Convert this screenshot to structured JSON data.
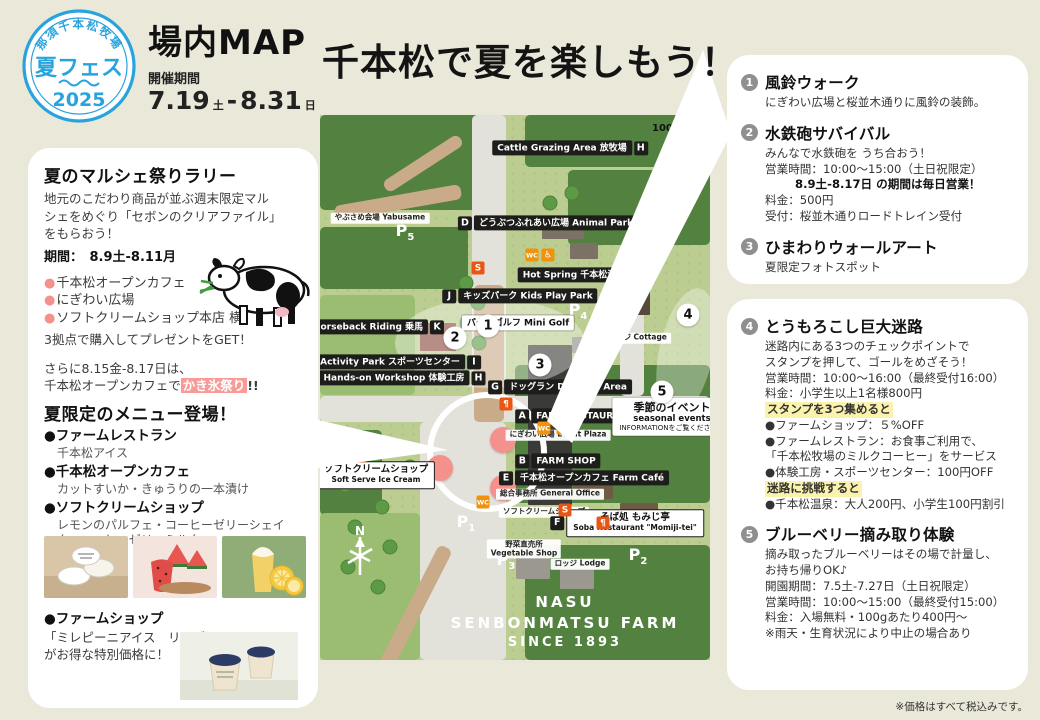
{
  "badge": {
    "farm": "那須千本松牧場",
    "event": "夏フェス",
    "year": "2025"
  },
  "header": {
    "title": "場内MAP",
    "period_label": "開催期間",
    "date_start": "7.19",
    "day_start": "土",
    "dash": "-",
    "date_end": "8.31",
    "day_end": "日"
  },
  "main_title": "千本松で夏を楽しもう！",
  "left_panel": {
    "rally": {
      "title": "夏のマルシェ祭りラリー",
      "body1": "地元のこだわり商品が並ぶ週末限定マル",
      "body2": "シェをめぐり「セボンのクリアファイル」",
      "body3": "をもらおう！",
      "period": "期間：　8.9土-8.11月",
      "spots": [
        "千本松オープンカフェ",
        "にぎわい広場",
        "ソフトクリームショップ本店 横"
      ],
      "get_line": "3拠点で購入してプレゼントをGET！",
      "extra1": "さらに8.15金-8.17日は、",
      "extra2": "千本松オープンカフェで",
      "extra_highlight": "かき氷祭り",
      "extra_suffix": "!!"
    },
    "menu": {
      "title": "夏限定のメニュー登場！",
      "items": [
        {
          "name": "ファームレストラン",
          "desc": "千本松アイス"
        },
        {
          "name": "千本松オープンカフェ",
          "desc": "カットすいか・きゅうりの一本漬け"
        },
        {
          "name": "ソフトクリームショップ",
          "desc": "レモンのパルフェ・コーヒーゼリーシェイク・コーヒーゼリーミルク"
        }
      ]
    },
    "shop": {
      "name": "ファームショップ",
      "desc1": "「ミレピーニアイス　リンゴ&ラ・フランス」",
      "desc2": "がお得な特別価格に！"
    },
    "photos": [
      "ice-cream-cups-photo",
      "watermelon-cup-photo",
      "lemon-parfait-photo",
      "milepini-ice-photo"
    ]
  },
  "map": {
    "scale": "100m",
    "compass": "N",
    "farm_sign": {
      "line1": "NASU",
      "line2": "SENBONMATSU FARM",
      "line3": "SINCE 1893"
    },
    "labels": [
      {
        "text": "Cattle Grazing Area 放牧場",
        "letter": "H",
        "letter_pos": "after",
        "type": "black",
        "x": 250,
        "y": 33
      },
      {
        "text": "やぶさめ会場 Yabusame",
        "type": "tiny",
        "x": 60,
        "y": 103
      },
      {
        "text": "どうぶつふれあい広場 Animal Park",
        "letter": "D",
        "letter_pos": "before",
        "type": "black",
        "x": 228,
        "y": 108
      },
      {
        "text": "Hot Spring 千本松温泉",
        "letter": "L",
        "letter_pos": "after",
        "type": "black",
        "x": 262,
        "y": 160
      },
      {
        "text": "キッズパーク Kids Play Park",
        "letter": "J",
        "letter_pos": "before",
        "type": "black",
        "x": 200,
        "y": 181
      },
      {
        "text": "パターゴルフ Mini Golf",
        "type": "whitebox",
        "x": 198,
        "y": 208
      },
      {
        "text": "コテージ Cottage",
        "type": "tiny",
        "x": 314,
        "y": 223
      },
      {
        "text": "Horseback Riding 乗馬",
        "letter": "K",
        "letter_pos": "after",
        "type": "black",
        "x": 56,
        "y": 212
      },
      {
        "text": "Activity Park スポーツセンター",
        "letter": "I",
        "letter_pos": "after",
        "type": "black",
        "x": 78,
        "y": 247
      },
      {
        "text": "Hands-on Workshop 体験工房",
        "letter": "H",
        "letter_pos": "after",
        "type": "black",
        "x": 82,
        "y": 263
      },
      {
        "text": "ドッグラン Dog Run Area",
        "letter": "G",
        "letter_pos": "before",
        "type": "black",
        "x": 240,
        "y": 272
      },
      {
        "text": "FARM RESTAURANT",
        "letter": "A",
        "letter_pos": "before",
        "type": "black",
        "x": 257,
        "y": 301
      },
      {
        "text": "にぎわい広場 Event Plaza",
        "type": "tiny",
        "x": 238,
        "y": 320
      },
      {
        "text": "FARM SHOP",
        "letter": "B",
        "letter_pos": "before",
        "type": "black",
        "x": 238,
        "y": 346
      },
      {
        "text": "千本松オープンカフェ Farm Café",
        "letter": "E",
        "letter_pos": "before",
        "type": "black",
        "x": 264,
        "y": 363
      },
      {
        "text": "総合事務所 General Office",
        "type": "tiny",
        "x": 230,
        "y": 379
      },
      {
        "text": "ソフトクリームショップ",
        "sub2": "Soft Serve Ice Cream",
        "letter": "C",
        "letter_pos": "before",
        "type": "whitebox2",
        "x": 48,
        "y": 360
      },
      {
        "text": "ソフトクリームショップ",
        "type": "tiny",
        "x": 224,
        "y": 397
      },
      {
        "text": "そば処 もみじ亭",
        "sub2": "Soba Restaurant \"Momiji-tei\"",
        "letter": "F",
        "letter_pos": "before",
        "type": "whitebox2",
        "x": 307,
        "y": 408
      },
      {
        "text": "野菜直売所",
        "sub2": "Vegetable Shop",
        "type": "tiny",
        "x": 204,
        "y": 434
      },
      {
        "text": "ロッジ Lodge",
        "type": "tiny",
        "x": 260,
        "y": 449
      },
      {
        "text": "季節のイベント",
        "sub2": "seasonal events",
        "sub3": "INFORMATIONをご覧ください。",
        "type": "info",
        "x": 352,
        "y": 302
      }
    ],
    "parking": [
      "P5",
      "P4",
      "P1",
      "P3",
      "P2"
    ],
    "parking_pos": [
      {
        "x": 85,
        "y": 117
      },
      {
        "x": 258,
        "y": 196
      },
      {
        "x": 146,
        "y": 408
      },
      {
        "x": 186,
        "y": 446
      },
      {
        "x": 318,
        "y": 441
      }
    ],
    "numbers": [
      {
        "n": "1",
        "x": 168,
        "y": 211
      },
      {
        "n": "2",
        "x": 135,
        "y": 223
      },
      {
        "n": "3",
        "x": 220,
        "y": 250
      },
      {
        "n": "4",
        "x": 368,
        "y": 200
      },
      {
        "n": "5",
        "x": 342,
        "y": 277
      }
    ],
    "markers": [
      {
        "x": 183,
        "y": 325
      },
      {
        "x": 120,
        "y": 353
      },
      {
        "x": 183,
        "y": 373
      }
    ],
    "amenities": [
      {
        "icon": "restroom-icon",
        "cls": "or",
        "glyph": "WC",
        "x": 212,
        "y": 140
      },
      {
        "icon": "wheelchair-icon",
        "cls": "or",
        "glyph": "♿",
        "x": 228,
        "y": 140
      },
      {
        "icon": "restaurant-icon",
        "cls": "rd",
        "glyph": "¶",
        "x": 186,
        "y": 289
      },
      {
        "icon": "restroom-icon",
        "cls": "or",
        "glyph": "WC",
        "x": 224,
        "y": 313
      },
      {
        "icon": "wheelchair-icon",
        "cls": "or",
        "glyph": "♿",
        "x": 243,
        "y": 313
      },
      {
        "icon": "softserve-icon",
        "cls": "rd",
        "glyph": "S",
        "x": 158,
        "y": 153
      },
      {
        "icon": "softserve-icon",
        "cls": "rd",
        "glyph": "S",
        "x": 40,
        "y": 341
      },
      {
        "icon": "softserve-icon",
        "cls": "rd",
        "glyph": "S",
        "x": 245,
        "y": 395
      },
      {
        "icon": "restroom-icon",
        "cls": "or",
        "glyph": "WC",
        "x": 163,
        "y": 387
      },
      {
        "icon": "restaurant-icon",
        "cls": "rd",
        "glyph": "¶",
        "x": 283,
        "y": 408
      }
    ]
  },
  "right_panel": {
    "boxes": [
      {
        "events": [
          {
            "num": "1",
            "title": "風鈴ウォーク",
            "lines": [
              [
                "n",
                "にぎわい広場と桜並木通りに風鈴の装飾。"
              ]
            ]
          },
          {
            "num": "2",
            "title": "水鉄砲サバイバル",
            "lines": [
              [
                "n",
                "みんなで水鉄砲を うち合おう！"
              ],
              [
                "n",
                "営業時間：10:00〜15:00（土日祝限定）"
              ],
              [
                "b",
                "8.9土-8.17日 の期間は毎日営業！"
              ],
              [
                "n",
                "料金：500円"
              ],
              [
                "n",
                "受付：桜並木通りロードトレイン受付"
              ]
            ]
          },
          {
            "num": "3",
            "title": "ひまわりウォールアート",
            "lines": [
              [
                "n",
                "夏限定フォトスポット"
              ]
            ]
          }
        ]
      },
      {
        "events": [
          {
            "num": "4",
            "title": "とうもろこし巨大迷路",
            "lines": [
              [
                "n",
                "迷路内にある3つのチェックポイントで"
              ],
              [
                "n",
                "スタンプを押して、ゴールをめざそう！"
              ],
              [
                "n",
                "営業時間：10:00〜16:00（最終受付16:00）"
              ],
              [
                "n",
                "料金：小学生以上1名様800円"
              ],
              [
                "h",
                "スタンプを3つ集めると"
              ],
              [
                "n",
                "●ファームショップ：５%OFF"
              ],
              [
                "n",
                "●ファームレストラン：お食事ご利用で、"
              ],
              [
                "n",
                "「千本松牧場のミルクコーヒー」をサービス"
              ],
              [
                "n",
                "●体験工房・スポーツセンター：100円OFF"
              ],
              [
                "h",
                "迷路に挑戦すると"
              ],
              [
                "n",
                "●千本松温泉：大人200円、小学生100円割引"
              ]
            ]
          },
          {
            "num": "5",
            "title": "ブルーベリー摘み取り体験",
            "lines": [
              [
                "n",
                "摘み取ったブルーベリーはその場で計量し、"
              ],
              [
                "n",
                "お持ち帰りOK♪"
              ],
              [
                "n",
                "開園期間：7.5土-7.27日（土日祝限定）"
              ],
              [
                "n",
                "営業時間：10:00〜15:00（最終受付15:00）"
              ],
              [
                "n",
                "料金：入場無料・100gあたり400円〜"
              ],
              [
                "n",
                "※雨天・生育状況により中止の場合あり"
              ]
            ]
          }
        ]
      }
    ]
  },
  "footer_note": "※価格はすべて税込みです。",
  "colors": {
    "accent_blue": "#29a3dd",
    "highlight_pink": "#f79b98",
    "highlight_yellow": "#fbf2ad",
    "marker_salmon": "#f5918c"
  }
}
